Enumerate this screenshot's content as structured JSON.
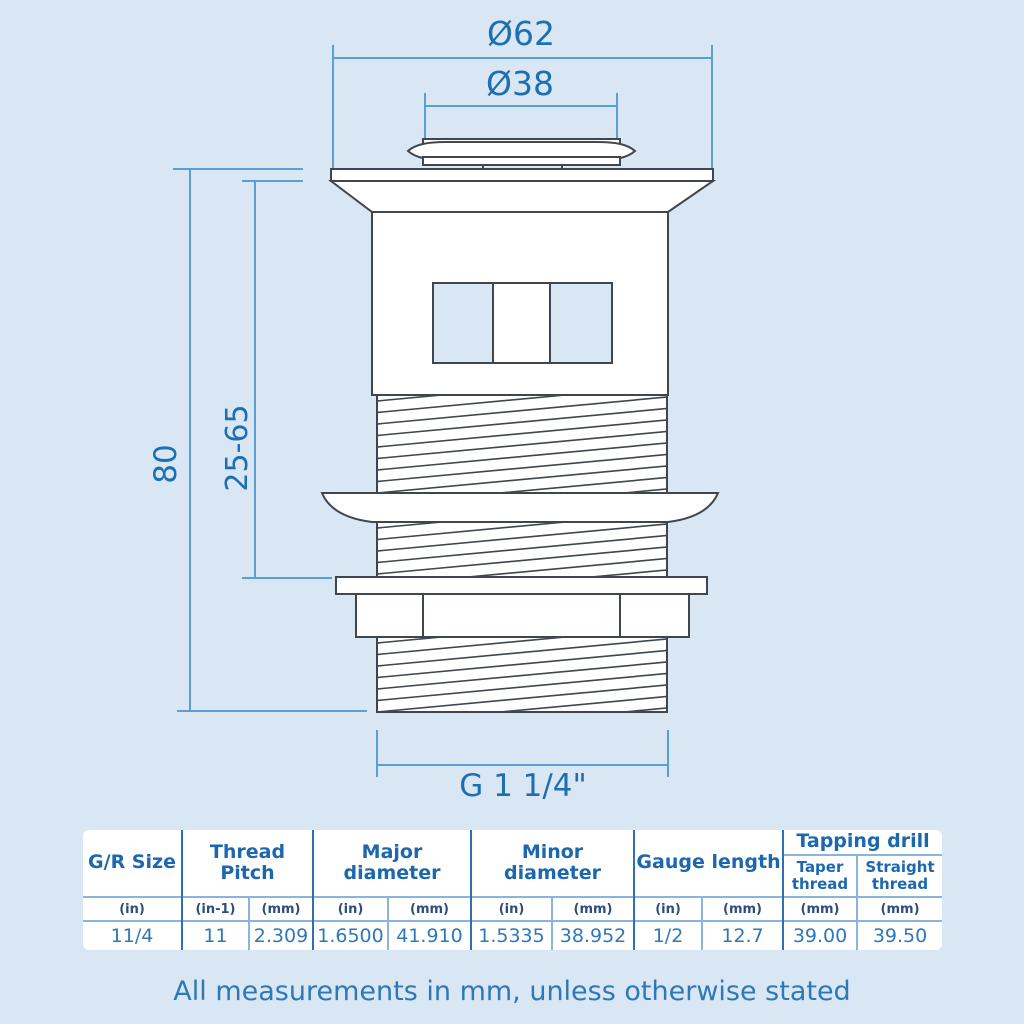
{
  "colors": {
    "background": "#d9e7f4",
    "drawing_line": "#3f464d",
    "dimension_line": "#5a9ed2",
    "dimension_text": "#1e6fb2",
    "table_main_divider": "#2f6fb2",
    "table_light_divider": "#8ab4dc",
    "table_header_text": "#1c67ad",
    "table_unit_text": "#2f4d7c",
    "table_value_text": "#2e78b8",
    "footer_text": "#2e78b8"
  },
  "dimensions": {
    "outer_diameter": "Ø62",
    "plug_diameter": "Ø38",
    "overall_length": "80",
    "clamp_range": "25-65",
    "thread_size": "G 1 1/4\""
  },
  "table": {
    "groups": [
      {
        "label": "G/R Size"
      },
      {
        "label": "Thread Pitch"
      },
      {
        "label": "Major diameter"
      },
      {
        "label": "Minor diameter"
      },
      {
        "label": "Gauge length"
      },
      {
        "label": "Tapping drill",
        "sub": [
          "Taper thread",
          "Straight thread"
        ]
      }
    ],
    "units": [
      "(in)",
      "(in-1)",
      "(mm)",
      "(in)",
      "(mm)",
      "(in)",
      "(mm)",
      "(in)",
      "(mm)",
      "(mm)",
      "(mm)"
    ],
    "values": [
      "11/4",
      "11",
      "2.309",
      "1.6500",
      "41.910",
      "1.5335",
      "38.952",
      "1/2",
      "12.7",
      "39.00",
      "39.50"
    ]
  },
  "footer": {
    "note": "All measurements in mm, unless otherwise stated"
  }
}
